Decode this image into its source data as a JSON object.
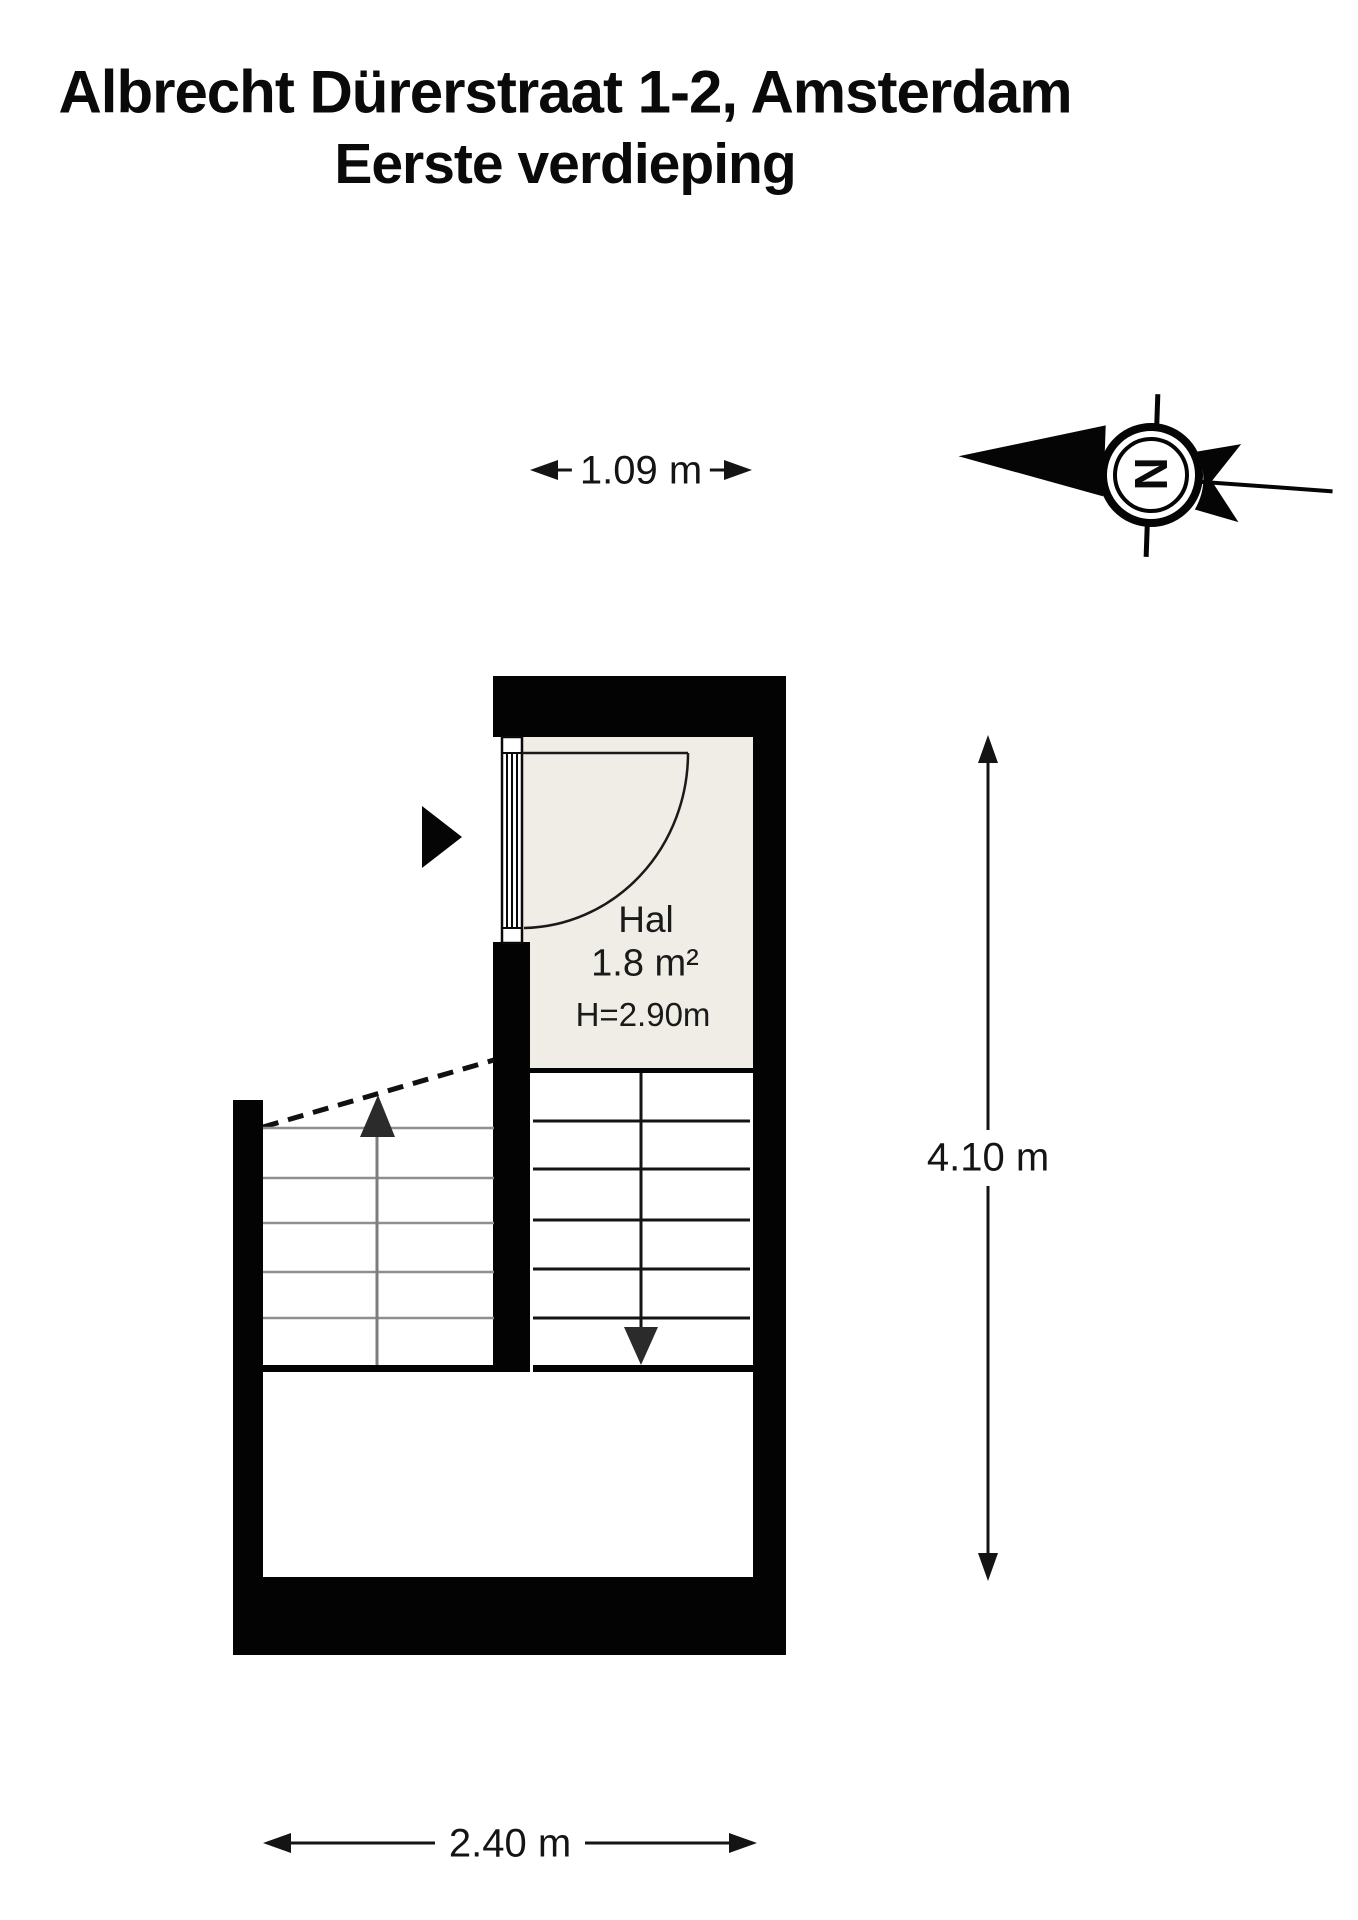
{
  "title": {
    "line1": "Albrecht Dürerstraat 1-2, Amsterdam",
    "line2": "Eerste verdieping"
  },
  "room": {
    "name": "Hal",
    "area": "1.8 m²",
    "ceiling_height": "H=2.90m"
  },
  "dimensions": {
    "top_width": "1.09 m",
    "right_height": "4.10 m",
    "bottom_width": "2.40 m"
  },
  "compass": {
    "letter": "N",
    "meaning": "north indicator pointing left"
  },
  "colors": {
    "wall": "#000000",
    "hall_floor": "#EFEDE6",
    "stair_tread_light": "#8f8f8f",
    "ink": "#141414"
  }
}
